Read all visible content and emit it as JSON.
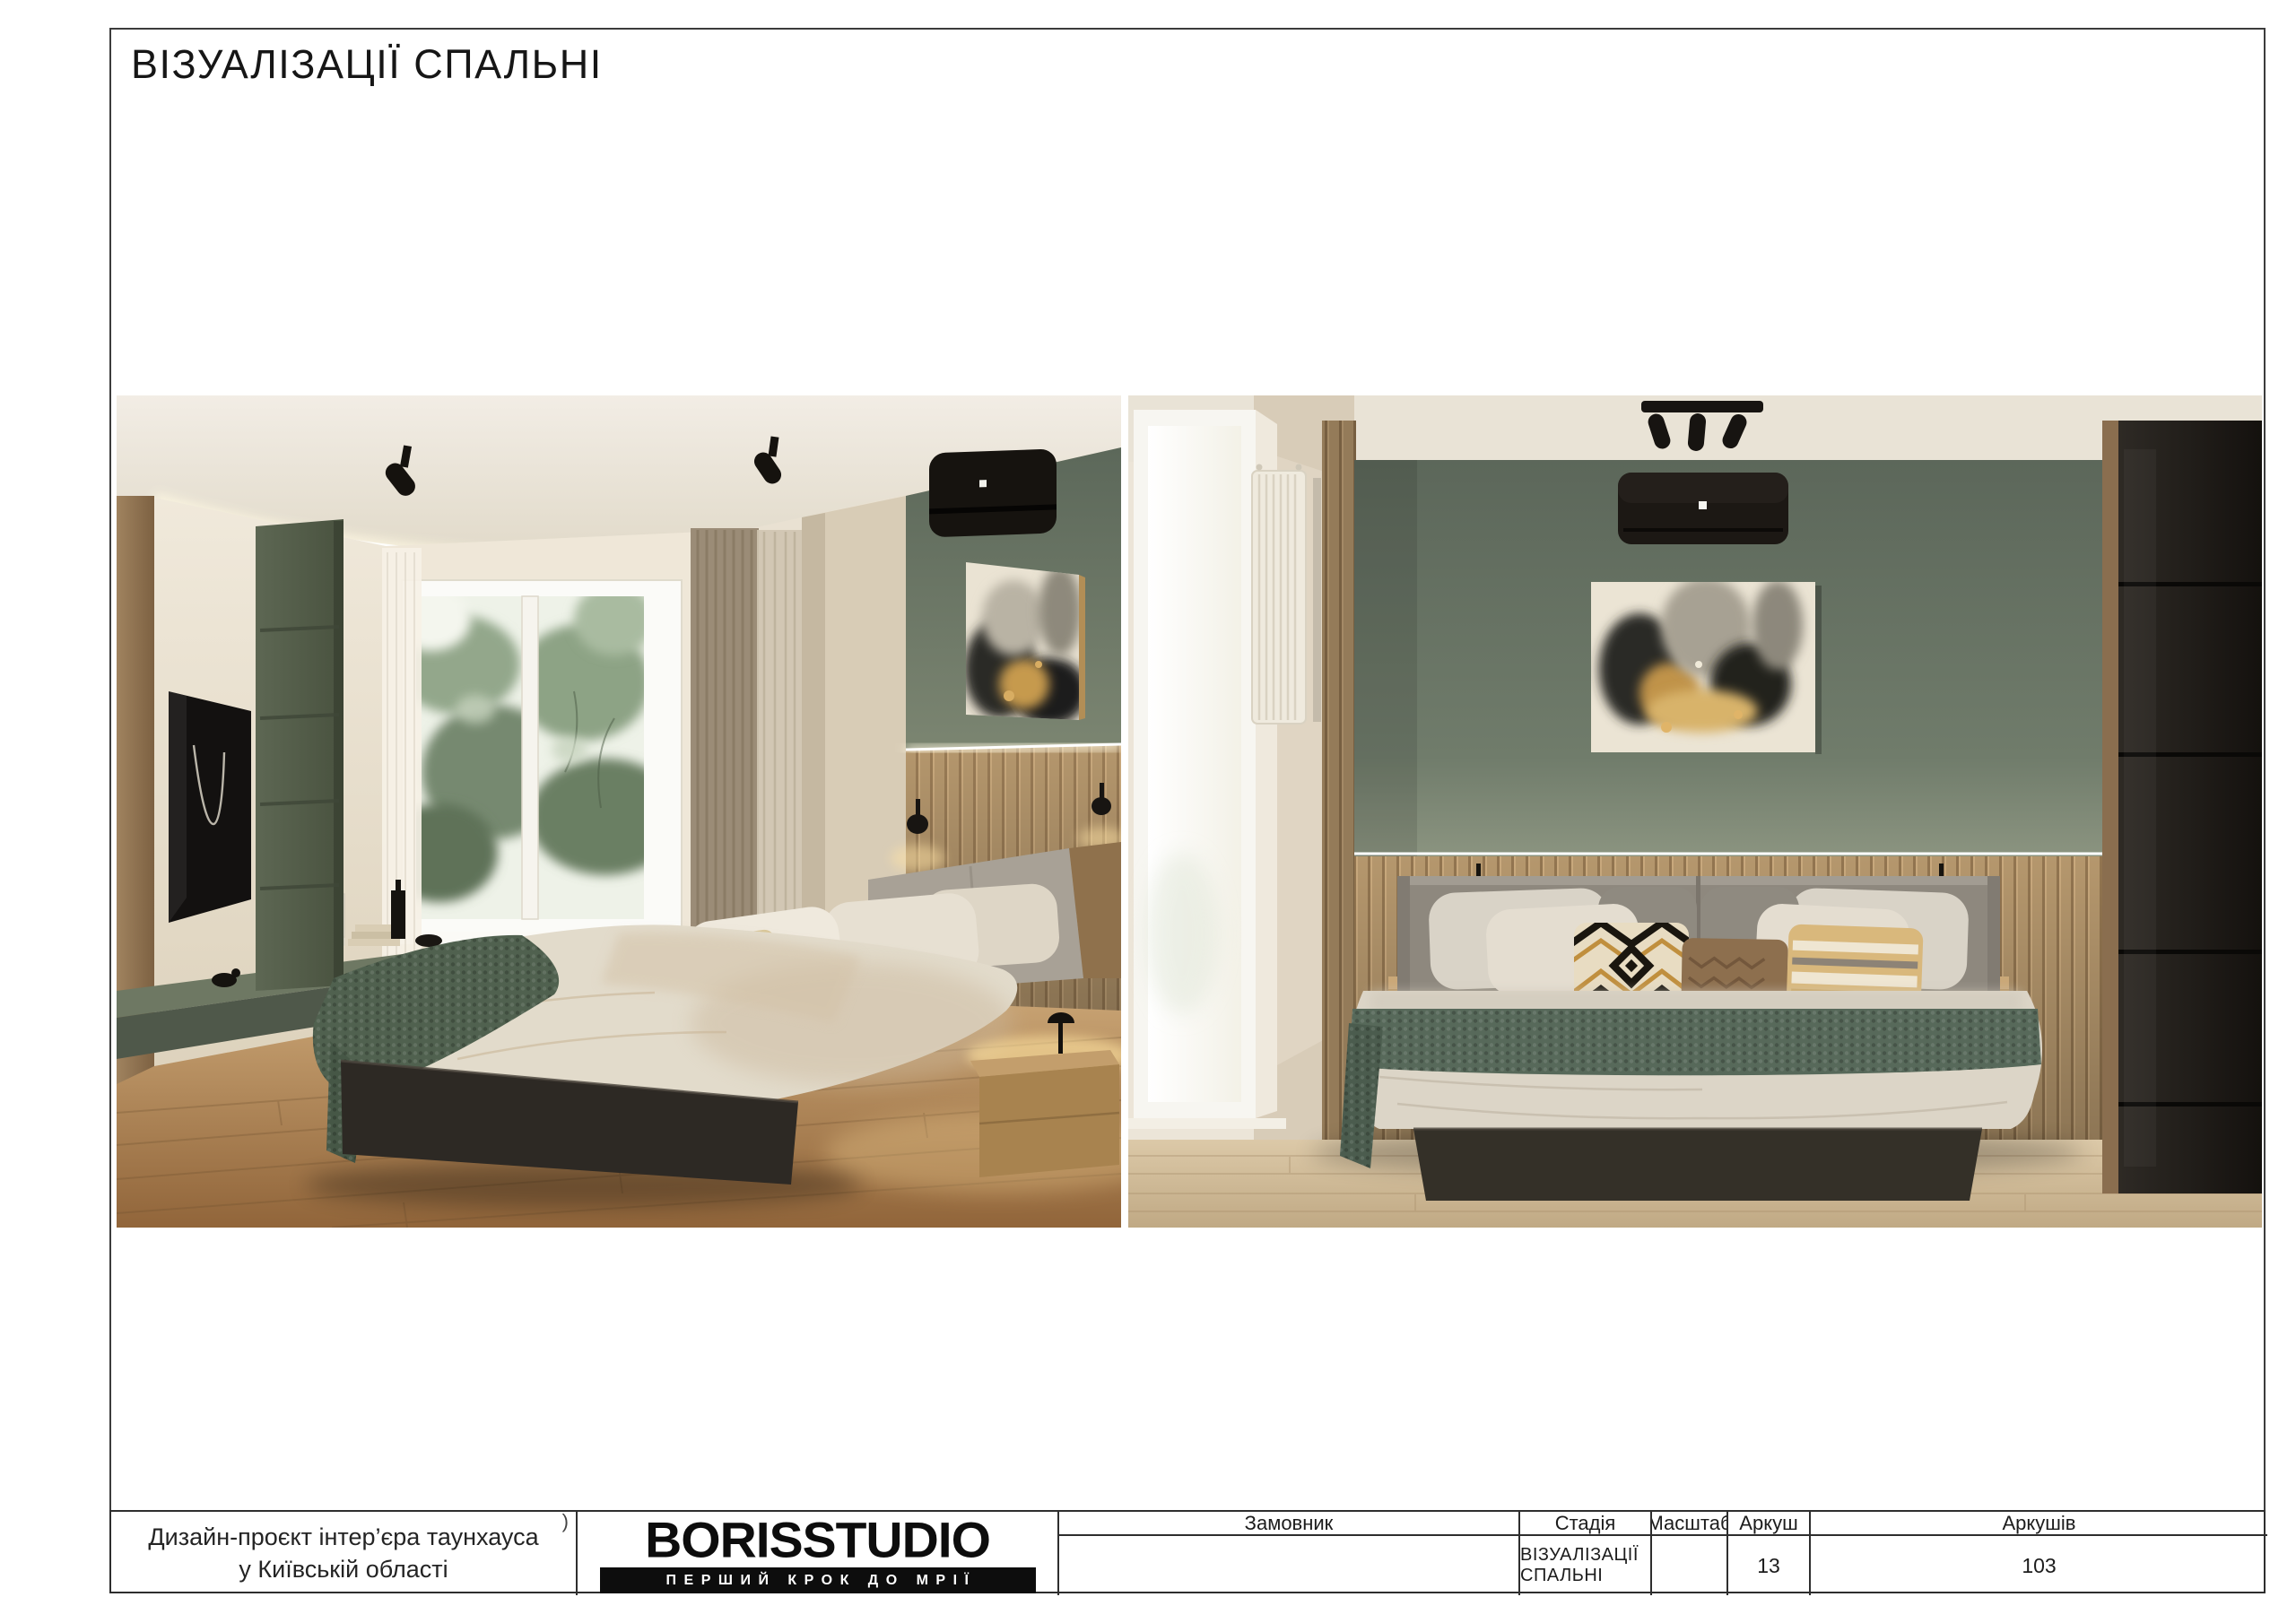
{
  "page": {
    "title": "ВІЗУАЛІЗАЦІЇ СПАЛЬНІ"
  },
  "title_block": {
    "project": "Дизайн-проєкт інтер’єра таунхауса у Київській області",
    "corner_mark": ")",
    "customer_label": "Замовник",
    "customer_value": "",
    "stage_label": "Стадія",
    "stage_value": "ВІЗУАЛІЗАЦІЇ СПАЛЬНІ",
    "scale_label": "Масштаб",
    "scale_value": "",
    "sheet_label": "Аркуш",
    "sheet_value": "13",
    "sheets_label": "Аркушів",
    "sheets_value": "103"
  },
  "logo": {
    "name": "BORISSTUDIO",
    "tagline": "ПЕРШИЙ КРОК ДО МРІЇ"
  },
  "colors": {
    "accent_wall_green": "#6f7b6a",
    "cabinet_olive": "#57604e",
    "wood_slat": "#b5976d",
    "floor_wood": "#c2996b",
    "textile_green": "#57695a",
    "bed_base_dark": "#2f2b26",
    "logo_black": "#0d0d0d"
  }
}
